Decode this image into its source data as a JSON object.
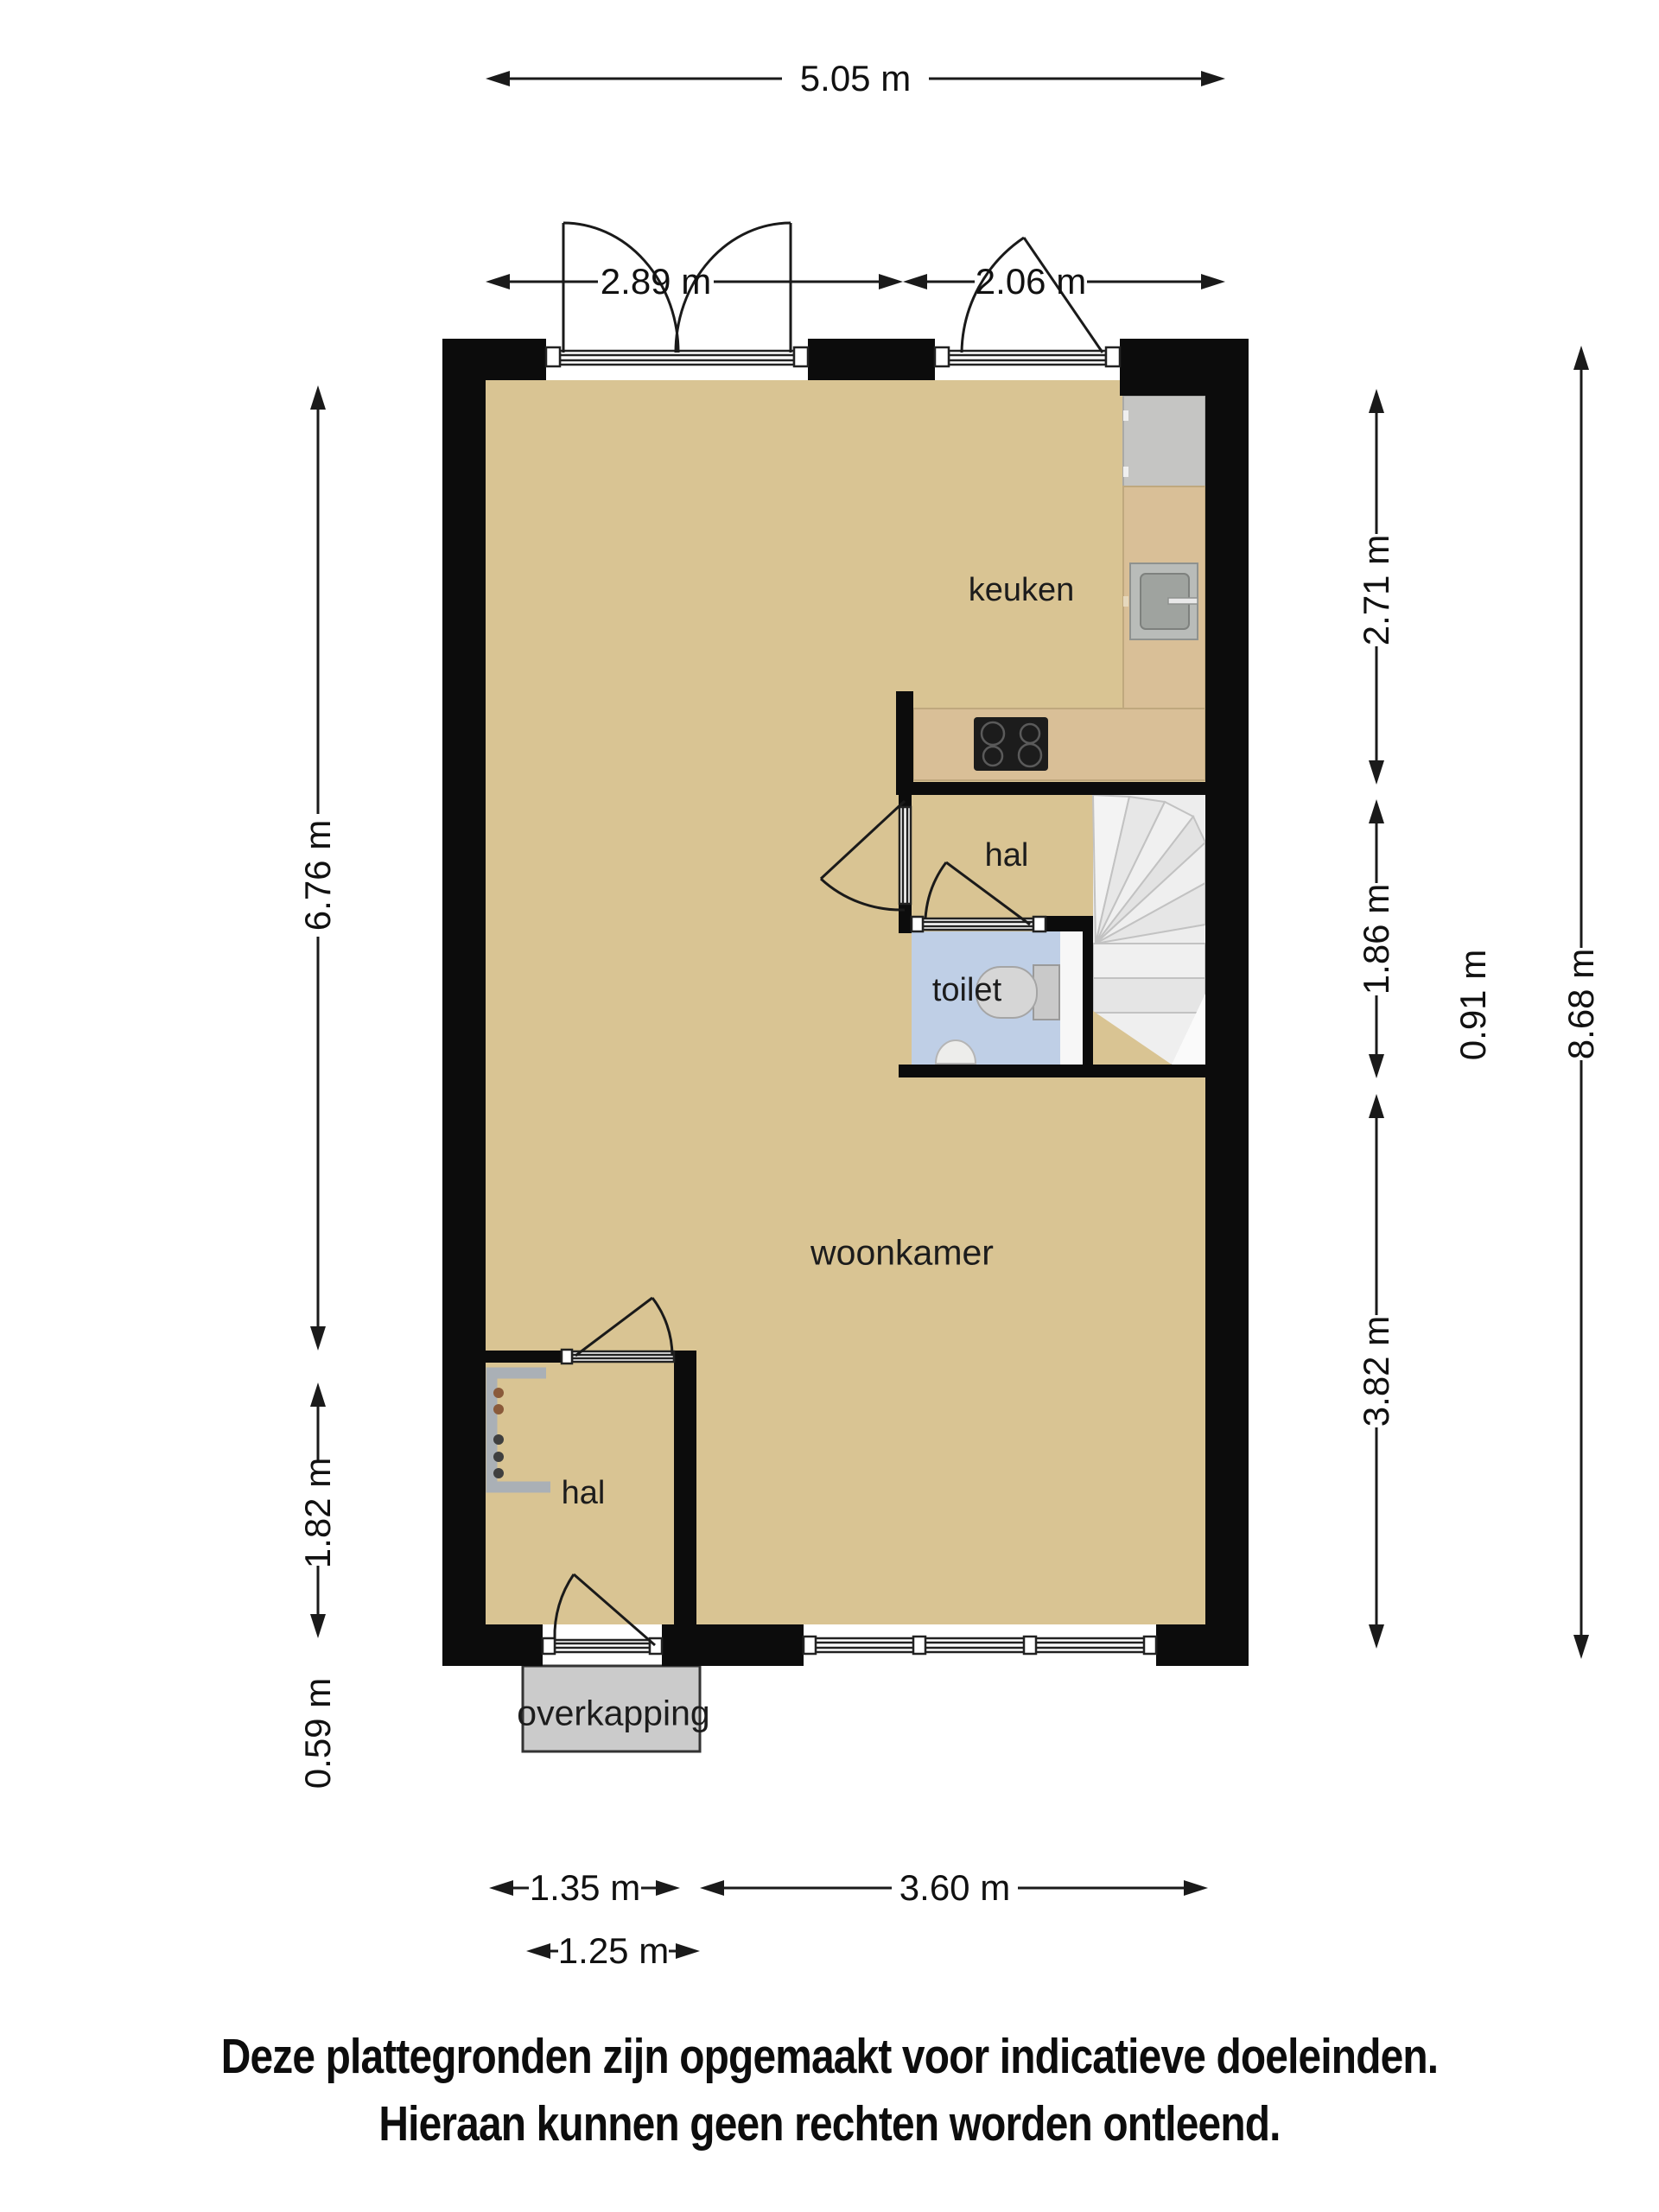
{
  "rooms": {
    "keuken": "keuken",
    "hal_top": "hal",
    "toilet": "toilet",
    "woonkamer": "woonkamer",
    "hal_bottom": "hal",
    "overkapping": "overkapping"
  },
  "dimensions": {
    "top_total": "5.05 m",
    "top_left": "2.89 m",
    "top_right": "2.06 m",
    "left_upper": "6.76 m",
    "left_middle": "1.82 m",
    "left_lower": "0.59 m",
    "right_upper": "2.71 m",
    "right_middle": "1.86 m",
    "right_inner": "0.91 m",
    "right_lower": "3.82 m",
    "right_total": "8.68 m",
    "bottom_left": "1.35 m",
    "bottom_right": "3.60 m",
    "bottom_overkapping": "1.25 m"
  },
  "disclaimer": {
    "line1": "Deze plattegronden zijn opgemaakt voor indicatieve doeleinden.",
    "line2": "Hieraan kunnen geen rechten worden ontleend."
  },
  "colors": {
    "wall": "#0c0c0c",
    "floor": "#d9c493",
    "toilet_floor": "#bfcfe6",
    "counter": "#d9bf97",
    "appliance": "#c5c5c3",
    "stove": "#1c1c1c",
    "sink_outer": "#b9bcb9",
    "sink_inner": "#9fa39f",
    "stairs_bg": "#ededed",
    "overkapping": "#cbcbcb",
    "fixture": "#aab0b6"
  }
}
